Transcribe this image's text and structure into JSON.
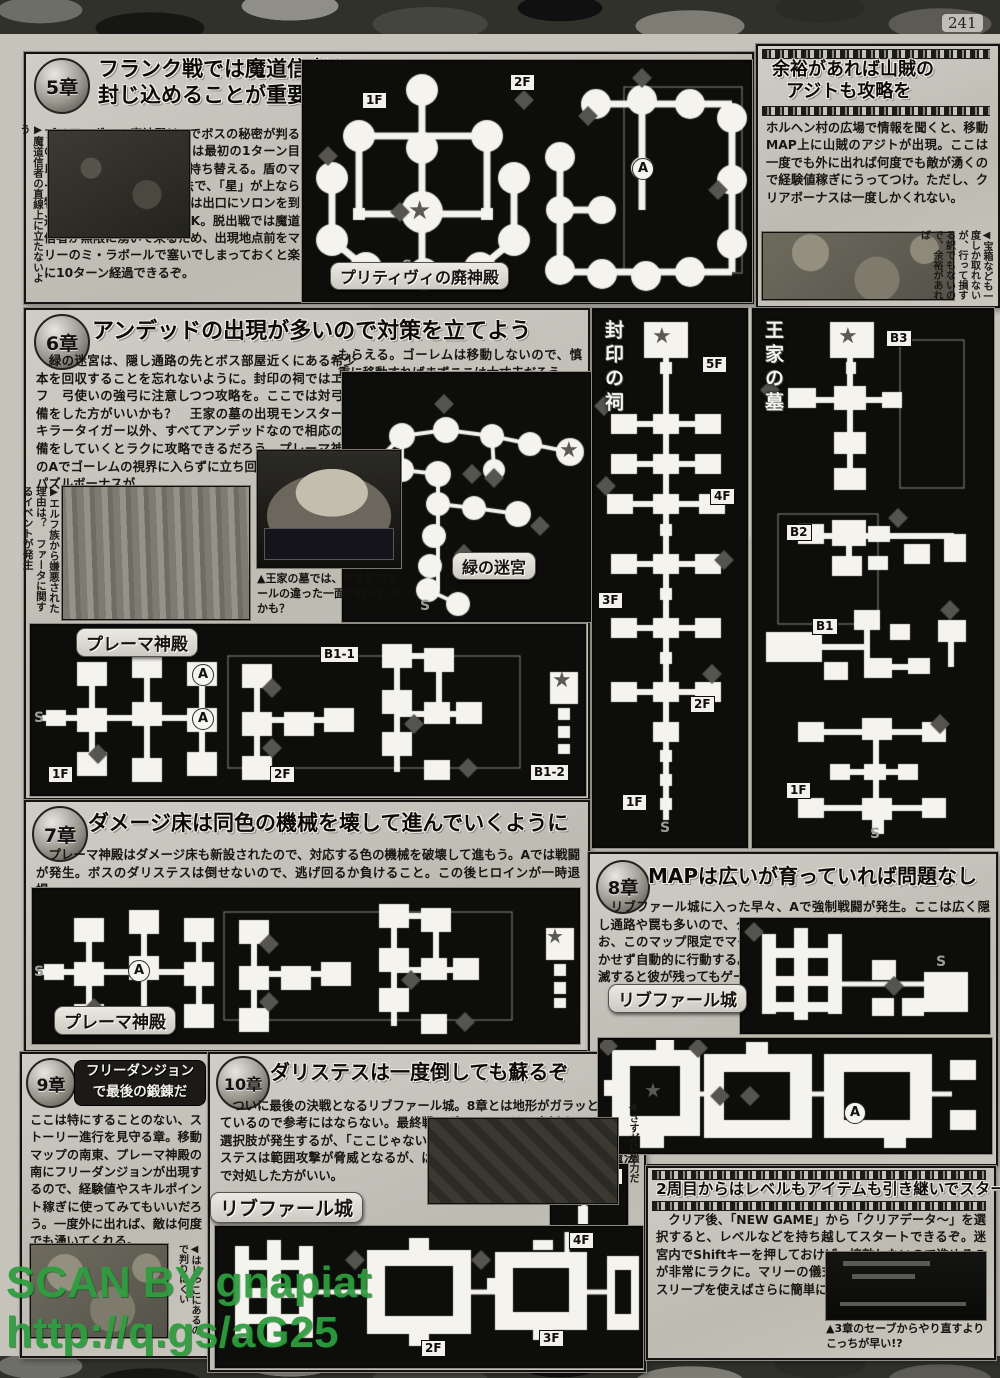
{
  "page": {
    "number": "241",
    "watermark_l1": "SCAN BY gnapiat",
    "watermark_l2": "http://q.gs/aG25"
  },
  "sidebar_bandit": {
    "title_l1": "余裕があれば山賊の",
    "title_l2": "アジトも攻略を",
    "body": "ホルヘン村の広場で情報を聞くと、移動MAP上に山賊のアジトが出現。ここは一度でも外に出れば何度でも敵が湧くので経験値稼ぎにうってつけ。ただし、クリアボーナスは一度しかくれない。",
    "photo_caption": "◀宝箱なども一度しか取れないが、行って損する訳でもないので、余裕があれば"
  },
  "ch5": {
    "badge": "5章",
    "title_l1": "フランク戦では魔道信者を",
    "title_l2": "封じ込めることが重要",
    "photo_caption": "▶魔道信者の直線上に立たないよう",
    "body": "プリティヴィの廃神殿はAでボスの秘密が判るので、覚えておこう。ボスは最初の1ターン目以外は2ターンごとに盾を持ち替える。盾のマークの「月」が上なら魔法で、「星」が上なら物理で攻撃すること。検問は出口にソロンを到達させても全滅させてもOK。脱出戦では魔道信者が無限に湧いて来るため、出現地点前をマリーのミ・ラボールで塞いでしまっておくと楽に10ターン経過できるぞ。"
  },
  "ch6": {
    "badge": "6章",
    "title": "アンデッドの出現が多いので対策を立てよう",
    "body_left": "　緑の迷宮は、隠し通路の先とボス部屋近くにある希少本を回収することを忘れないように。封印の祠ではエルフ　弓使いの強弓に注意しつつ攻略を。ここでは対弓装備をした方がいいかも？　王家の墓の出現モンスターはキラータイガー以外、すべてアンデッドなので相応の装備をしていくとラクに攻略できるだろう。プレーマ神殿のAでゴーレムの視界に入らずに立ち回ると、クリア時にパズルボーナスが",
    "body_right": "もらえる。ゴーレムは移動しないので、慎重に移動すればまずここは大丈夫だろう。",
    "art_caption": "▶エルフ族から嫌悪された理由は？　ファータに関するイベントが発生",
    "photo_caption": "▲王家の墓では、ヤサ男のカールの違った一面が見られるかも？"
  },
  "ch7": {
    "badge": "7章",
    "title": "ダメージ床は同色の機械を壊して進んでいくように",
    "body": "　プレーマ神殿はダメージ床も新設されたので、対応する色の機械を破壊して進もう。Aでは戦闘が発生。ボスのダリステスは倒せないので、逃げ回るか負けること。この後ヒロインが一時退場。"
  },
  "ch8": {
    "badge": "8章",
    "title": "MAPは広いが育っていれば問題なし",
    "body": "　リブファール城に入った早々、Aで強制戦闘が発生。ここは広く隠し通路や罠も多いので、クリンを先頭にしてPAを使いつつ進もう。なお、このマップ限定でマグナガルドが仲間に入るが、プレイヤーは動かせず自動的に行動する。彼は全攻撃を回避するが、ソロンたちが全滅すると彼が残ってもゲームオーバーなので注意。"
  },
  "ch9": {
    "badge": "9章",
    "title_l1": "フリーダンジョン",
    "title_l2": "で最後の鍛錬だ",
    "body": "ここは特にすることのない、ストーリー進行を見守る章。移動マップの南東、プレーマ神殿の南にフリーダンジョンが出現するので、経験値やスキルポイント稼ぎに使ってみてもいいだろう。一度外に出れば、敵は何度でも湧いてくれる。",
    "photo_caption": "◀はじっこにあるので判りにくい"
  },
  "ch10": {
    "badge": "10章",
    "title": "ダリステスは一度倒しても蘇るぞ",
    "body": "　ついに最後の決戦となるリブファール城。8章とは地形がガラッと変わっているので参考にはならない。最終戦のダリステスは一度倒すとイベント選択肢が発生するが、「ここじゃない」を選び続ければOK。二度目のダリステスは範囲攻撃が脅威となるが、ばらけるよりもマリーの全体回復魔法で対処した方がいい。",
    "photo_caption": "◀さすがに強力だ"
  },
  "newgame": {
    "title": "2周目からはレベルもアイテムも引き継いでスタート!!",
    "body": "　クリア後、「NEW GAME」から「クリアデータ～」を選択すると、レベルなどを持ち越してスタートできるぞ。迷宮内でShiftキーを押しておけば、接敵しないので進めるのが非常にラクに。マリーの儀式魔法のサーチ、アラート、スリープを使えばさらに簡単になるのでお試しを。",
    "photo_caption": "▲3章のセーブからやり直すよりこっちが早い!?"
  },
  "maps": {
    "pritivi": {
      "name": "プリティヴィの廃神殿",
      "f1": "1F",
      "f2": "2F",
      "a": "A",
      "s": "S",
      "star": "★"
    },
    "fuuin": {
      "name": "封印の祠",
      "f5": "5F",
      "f4": "4F",
      "f3": "3F",
      "f2": "2F",
      "f1": "1F",
      "s": "S",
      "star": "★"
    },
    "ouke": {
      "name": "王家の墓",
      "b3": "B3",
      "b2": "B2",
      "b1": "B1",
      "f1": "1F",
      "s": "S",
      "star": "★"
    },
    "midori": {
      "name": "緑の迷宮",
      "s": "S",
      "star": "★"
    },
    "prema6": {
      "name": "プレーマ神殿",
      "b11": "B1-1",
      "b12": "B1-2",
      "f1": "1F",
      "f2": "2F",
      "a": "A",
      "s": "S",
      "star": "★"
    },
    "prema7": {
      "name": "プレーマ神殿",
      "a": "A",
      "s": "S",
      "star": "★"
    },
    "riv8": {
      "name": "リブファール城",
      "a": "A",
      "s": "S",
      "star": "★"
    },
    "riv10": {
      "name": "リブファール城",
      "f2": "2F",
      "f3": "3F",
      "f4": "4F",
      "f5": "5F",
      "star": "★"
    }
  }
}
